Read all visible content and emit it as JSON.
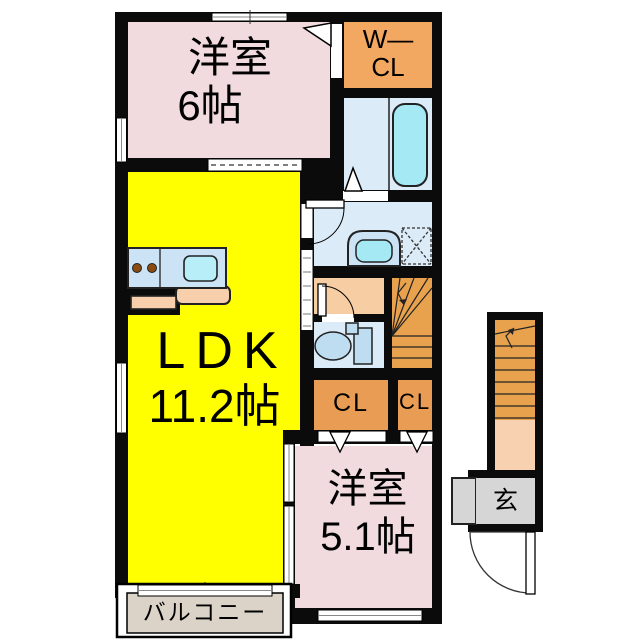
{
  "floorplan": {
    "rooms": {
      "bedroom_top": {
        "name": "洋室",
        "size": "6帖",
        "color": "#F1DBDE"
      },
      "walkin_closet": {
        "label_line1": "W—",
        "label_line2": "CL",
        "color": "#F3A862"
      },
      "bathroom": {
        "color": "#DCEBF8",
        "tub_color": "#A5E9F4"
      },
      "washroom": {
        "color": "#DCEBF8"
      },
      "toilet": {
        "color": "#DCEBF8"
      },
      "hallway": {
        "color": "#F7CDA4"
      },
      "stairs_inner": {
        "color": "#E8A24E"
      },
      "ldk": {
        "name": "LDK",
        "size": "11.2帖",
        "color": "#FFFF00"
      },
      "closet1": {
        "label": "CL",
        "color": "#E99C53"
      },
      "closet2": {
        "label": "CL",
        "color": "#E99C53"
      },
      "bedroom_bottom": {
        "name": "洋室",
        "size": "5.1帖",
        "color": "#F1DBDE"
      },
      "balcony": {
        "label": "バルコニー",
        "color": "#DBD3C7"
      },
      "entrance": {
        "label": "玄",
        "color": "#D6D6D6",
        "stairs_color": "#E8A24E",
        "landing_color": "#F8D2B0"
      }
    },
    "fixtures": {
      "kitchen_counter_color": "#CCE2F5",
      "kitchen_sink_color": "#B8EEF8",
      "kitchen_bar_color": "#F8CFAC",
      "burner_color": "#8A4A10",
      "sink_basin_color": "#A5E9F4",
      "toilet_fixture_color": "#BFDDF0",
      "wall_color": "#0b0b0b"
    }
  }
}
